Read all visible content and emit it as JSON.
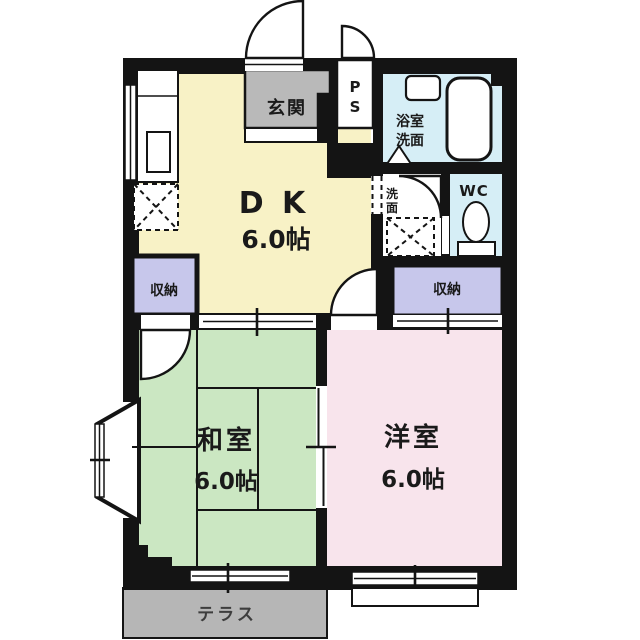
{
  "labels": {
    "dk": "D K",
    "dk_size": "6.0帖",
    "washitsu": "和室",
    "washitsu_size": "6.0帖",
    "youshitsu": "洋室",
    "youshitsu_size": "6.0帖",
    "genkan": "玄関",
    "ps_top": "P",
    "ps_bottom": "S",
    "bath_line1": "浴室",
    "bath_line2": "洗面",
    "senmen_line1": "洗",
    "senmen_line2": "面",
    "wc": "WC",
    "storage_left": "収納",
    "storage_right": "収納",
    "terrace": "テラス"
  },
  "colors": {
    "wall": "#141414",
    "dk": "#f8f2c6",
    "tatami": "#cbe7c2",
    "western": "#f8e4ec",
    "storage": "#c7c7eb",
    "bath": "#d6eef6",
    "entry": "#b9b9b9",
    "terrace": "#b6b6b6",
    "text": "#1a1a1a"
  }
}
